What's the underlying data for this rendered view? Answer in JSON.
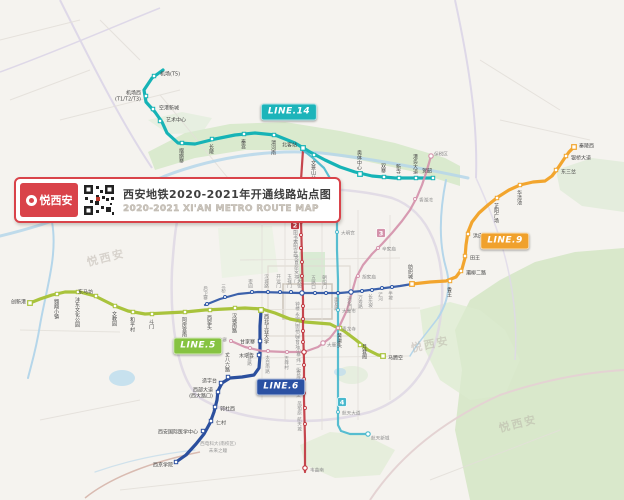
{
  "banner": {
    "logo_text": "悦西安",
    "title_cn": "西安地铁2020-2021年开通线路站点图",
    "title_en": "2020-2021 XI'AN METRO ROUTE MAP",
    "accent_color": "#d9434a"
  },
  "line_labels": [
    {
      "id": "14",
      "text": "LINE.14",
      "color": "#1cb4ba",
      "x": 289,
      "y": 112
    },
    {
      "id": "9",
      "text": "LINE.9",
      "color": "#f0a12c",
      "x": 505,
      "y": 241
    },
    {
      "id": "5",
      "text": "LINE.5",
      "color": "#86c341",
      "x": 198,
      "y": 346
    },
    {
      "id": "6",
      "text": "LINE.6",
      "color": "#2b51a3",
      "x": 281,
      "y": 387
    }
  ],
  "badges": [
    {
      "text": "2",
      "color": "#c13740",
      "x": 295,
      "y": 225
    },
    {
      "text": "3",
      "color": "#d492ab",
      "x": 381,
      "y": 233
    },
    {
      "text": "4",
      "color": "#49b9cd",
      "x": 342,
      "y": 402
    }
  ],
  "watermarks": [
    {
      "text": "悦西安",
      "x": 88,
      "y": 266,
      "angle": -14
    },
    {
      "text": "悦西安",
      "x": 412,
      "y": 352,
      "angle": -12
    },
    {
      "text": "悦西安",
      "x": 500,
      "y": 432,
      "angle": -14
    }
  ],
  "area_labels": [
    {
      "text": "西电科大(南校区)",
      "x": 218,
      "y": 445
    },
    {
      "text": "未来之瞳",
      "x": 218,
      "y": 452
    }
  ],
  "lines": [
    {
      "id": "14",
      "name": "14号线",
      "color": "#16b3b6",
      "w": 3.2,
      "new": true,
      "pts": [
        [
          163,
          70
        ],
        [
          152,
          78
        ],
        [
          144,
          90
        ],
        [
          146,
          102
        ],
        [
          155,
          112
        ],
        [
          162,
          122
        ],
        [
          167,
          133
        ],
        [
          178,
          143
        ],
        [
          195,
          144
        ],
        [
          215,
          139
        ],
        [
          235,
          135
        ],
        [
          255,
          133
        ],
        [
          275,
          135
        ],
        [
          295,
          143
        ],
        [
          310,
          152
        ],
        [
          325,
          160
        ],
        [
          340,
          167
        ],
        [
          355,
          172
        ],
        [
          372,
          176
        ],
        [
          395,
          178
        ],
        [
          433,
          178
        ]
      ]
    },
    {
      "id": "9",
      "name": "9号线",
      "color": "#f2a52e",
      "w": 3.2,
      "new": true,
      "pts": [
        [
          412,
          284
        ],
        [
          430,
          282
        ],
        [
          446,
          281
        ],
        [
          456,
          277
        ],
        [
          462,
          269
        ],
        [
          465,
          258
        ],
        [
          466,
          245
        ],
        [
          468,
          232
        ],
        [
          472,
          222
        ],
        [
          479,
          213
        ],
        [
          488,
          205
        ],
        [
          498,
          197
        ],
        [
          509,
          190
        ],
        [
          520,
          185
        ],
        [
          533,
          182
        ],
        [
          545,
          181
        ],
        [
          552,
          176
        ],
        [
          558,
          168
        ],
        [
          564,
          159
        ],
        [
          569,
          152
        ],
        [
          574,
          147
        ]
      ]
    },
    {
      "id": "5",
      "name": "5号线",
      "color": "#a9c33c",
      "w": 3.2,
      "new": true,
      "pts": [
        [
          30,
          303
        ],
        [
          40,
          299
        ],
        [
          52,
          295
        ],
        [
          65,
          292
        ],
        [
          80,
          292
        ],
        [
          95,
          296
        ],
        [
          105,
          301
        ],
        [
          115,
          306
        ],
        [
          128,
          311
        ],
        [
          145,
          314
        ],
        [
          165,
          313
        ],
        [
          185,
          312
        ],
        [
          205,
          310
        ],
        [
          225,
          309
        ],
        [
          245,
          308
        ],
        [
          262,
          309
        ],
        [
          275,
          313
        ],
        [
          290,
          319
        ],
        [
          305,
          322
        ],
        [
          330,
          324
        ],
        [
          344,
          331
        ],
        [
          356,
          340
        ],
        [
          368,
          350
        ],
        [
          378,
          355
        ],
        [
          384,
          356
        ]
      ]
    },
    {
      "id": "6",
      "name": "6号线",
      "color": "#2b4f9e",
      "w": 3.2,
      "new": true,
      "pts": [
        [
          176,
          462
        ],
        [
          186,
          455
        ],
        [
          196,
          444
        ],
        [
          204,
          434
        ],
        [
          210,
          423
        ],
        [
          214,
          412
        ],
        [
          217,
          400
        ],
        [
          218,
          391
        ],
        [
          222,
          383
        ],
        [
          230,
          378
        ],
        [
          242,
          377
        ],
        [
          254,
          375
        ],
        [
          259,
          368
        ],
        [
          260,
          355
        ],
        [
          260,
          340
        ],
        [
          260,
          326
        ],
        [
          261,
          311
        ]
      ]
    },
    {
      "id": "1",
      "name": "1号线",
      "color": "#2b55a5",
      "w": 2.2,
      "new": false,
      "pts": [
        [
          205,
          305
        ],
        [
          220,
          299
        ],
        [
          238,
          294
        ],
        [
          258,
          292
        ],
        [
          300,
          293
        ],
        [
          340,
          293
        ],
        [
          362,
          291
        ],
        [
          385,
          288
        ],
        [
          400,
          286
        ],
        [
          412,
          284
        ]
      ]
    },
    {
      "id": "2",
      "name": "2号线",
      "color": "#c13740",
      "w": 2.2,
      "new": false,
      "pts": [
        [
          303,
          150
        ],
        [
          301,
          180
        ],
        [
          301,
          220
        ],
        [
          302,
          260
        ],
        [
          303,
          300
        ],
        [
          303,
          330
        ],
        [
          304,
          360
        ],
        [
          304,
          400
        ],
        [
          305,
          440
        ],
        [
          305,
          472
        ]
      ]
    },
    {
      "id": "3",
      "name": "3号线",
      "color": "#d492ab",
      "w": 2.2,
      "new": false,
      "pts": [
        [
          231,
          341
        ],
        [
          245,
          347
        ],
        [
          262,
          351
        ],
        [
          285,
          352
        ],
        [
          304,
          352
        ],
        [
          318,
          347
        ],
        [
          330,
          338
        ],
        [
          340,
          325
        ],
        [
          347,
          310
        ],
        [
          352,
          292
        ],
        [
          356,
          278
        ],
        [
          363,
          265
        ],
        [
          372,
          254
        ],
        [
          382,
          244
        ],
        [
          392,
          233
        ],
        [
          402,
          221
        ],
        [
          410,
          210
        ],
        [
          417,
          197
        ],
        [
          422,
          185
        ],
        [
          426,
          173
        ],
        [
          429,
          163
        ],
        [
          431,
          156
        ]
      ]
    },
    {
      "id": "4",
      "name": "4号线",
      "color": "#49b9cd",
      "w": 2.2,
      "new": false,
      "pts": [
        [
          303,
          150
        ],
        [
          313,
          158
        ],
        [
          324,
          168
        ],
        [
          331,
          180
        ],
        [
          335,
          195
        ],
        [
          337,
          215
        ],
        [
          337,
          250
        ],
        [
          338,
          280
        ],
        [
          338,
          310
        ],
        [
          338,
          345
        ],
        [
          338,
          380
        ],
        [
          338,
          408
        ],
        [
          338,
          425
        ],
        [
          341,
          431
        ],
        [
          350,
          434
        ],
        [
          368,
          434
        ]
      ]
    }
  ],
  "stations": [
    [
      "机场(T5)",
      "14",
      154,
      76,
      160,
      74,
      "h",
      "s"
    ],
    [
      [
        "机场西",
        "(T1/T2/T3)"
      ],
      "14",
      146,
      96,
      141,
      93,
      "h",
      "e"
    ],
    [
      "空港新城",
      "14",
      153,
      109,
      159,
      108,
      "h",
      "s"
    ],
    [
      "艺术中心",
      "14",
      160,
      121,
      166,
      120,
      "h",
      "s"
    ],
    [
      "摆旗寨",
      "14",
      182,
      143,
      181,
      148,
      "v",
      "s"
    ],
    [
      "长陵",
      "14",
      212,
      139,
      211,
      144,
      "v",
      "s"
    ],
    [
      "秦宫",
      "14",
      244,
      134,
      243,
      139,
      "v",
      "s"
    ],
    [
      "渭河南",
      "14",
      274,
      135,
      273,
      140,
      "v",
      "s"
    ],
    [
      "北客站",
      "14",
      303,
      148,
      297,
      145,
      "h",
      "e",
      "m"
    ],
    [
      "文景山公园",
      "14",
      314,
      155,
      313,
      160,
      "v",
      "s"
    ],
    [
      "奥体中心",
      "14",
      360,
      174,
      359,
      170,
      "v",
      "e",
      "m"
    ],
    [
      "双寨",
      "14",
      384,
      177,
      383,
      173,
      "v",
      "e"
    ],
    [
      "新寺",
      "14",
      399,
      178,
      398,
      174,
      "v",
      "e"
    ],
    [
      "港务大道",
      "14",
      416,
      178,
      415,
      174,
      "v",
      "e"
    ],
    [
      "贺韶",
      "14",
      433,
      178,
      432,
      171,
      "h",
      "e"
    ],
    [
      "纺织城",
      "9",
      412,
      284,
      410,
      279,
      "v",
      "e",
      "m"
    ],
    [
      "香王",
      "9",
      450,
      281,
      449,
      287,
      "v",
      "s"
    ],
    [
      "灞柳二路",
      "9",
      461,
      271,
      466,
      273,
      "h",
      "s"
    ],
    [
      "田王",
      "9",
      465,
      256,
      470,
      258,
      "h",
      "s"
    ],
    [
      "洪庆",
      "9",
      468,
      234,
      473,
      236,
      "h",
      "s"
    ],
    [
      "芷阳广场",
      "9",
      497,
      198,
      496,
      203,
      "v",
      "s"
    ],
    [
      "华清池",
      "9",
      520,
      185,
      519,
      190,
      "v",
      "s"
    ],
    [
      "东三岔",
      "9",
      556,
      170,
      561,
      172,
      "h",
      "s"
    ],
    [
      "银桥大道",
      "9",
      566,
      156,
      571,
      158,
      "h",
      "s"
    ],
    [
      "秦陵西",
      "9",
      574,
      147,
      579,
      146,
      "h",
      "s",
      "m"
    ],
    [
      "创新港",
      "5",
      30,
      303,
      26,
      302,
      "h",
      "e",
      "m"
    ],
    [
      "翱翔小镇",
      "5",
      57,
      294,
      56,
      299,
      "v",
      "s"
    ],
    [
      "沣东文化公园",
      "5",
      78,
      292,
      77,
      297,
      "v",
      "s"
    ],
    [
      "东马坊",
      "5",
      96,
      296,
      93,
      292,
      "h",
      "e"
    ],
    [
      "文教园",
      "5",
      115,
      306,
      114,
      311,
      "v",
      "s"
    ],
    [
      "和平村",
      "5",
      133,
      312,
      132,
      317,
      "v",
      "s"
    ],
    [
      "斗门",
      "5",
      152,
      314,
      151,
      319,
      "v",
      "s"
    ],
    [
      "阿房宫南",
      "5",
      185,
      312,
      184,
      317,
      "v",
      "s"
    ],
    [
      "西窑头",
      "5",
      210,
      310,
      209,
      315,
      "v",
      "s"
    ],
    [
      "汉城南路",
      "5",
      235,
      308,
      234,
      313,
      "v",
      "s"
    ],
    [
      "西北工业大学",
      "5",
      261,
      310,
      266,
      314,
      "v",
      "s",
      "m"
    ],
    [
      "黄渠头",
      "5",
      340,
      328,
      339,
      333,
      "v",
      "s"
    ],
    [
      "月登阁",
      "5",
      360,
      345,
      364,
      344,
      "v",
      "s"
    ],
    [
      "马腾空",
      "5",
      383,
      356,
      388,
      358,
      "h",
      "s",
      "m"
    ],
    [
      "西京学院",
      "6",
      176,
      462,
      173,
      465,
      "h",
      "e"
    ],
    [
      "西安国际医学中心",
      "6",
      203,
      431,
      198,
      432,
      "h",
      "e"
    ],
    [
      "仁村",
      "6",
      211,
      421,
      216,
      423,
      "h",
      "s"
    ],
    [
      "郭杜西",
      "6",
      215,
      407,
      220,
      409,
      "h",
      "s"
    ],
    [
      [
        "西部大道",
        "(西大路口)"
      ],
      "6",
      218,
      392,
      213,
      390,
      "h",
      "e"
    ],
    [
      "造字台",
      "6",
      221,
      383,
      217,
      381,
      "h",
      "e"
    ],
    [
      "丈八六路",
      "6",
      228,
      377,
      227,
      372,
      "v",
      "e"
    ],
    [
      "木塔寺",
      "6",
      259,
      355,
      254,
      356,
      "h",
      "e"
    ],
    [
      "甘家寨",
      "6",
      260,
      341,
      255,
      342,
      "h",
      "e"
    ],
    [
      "后卫寨",
      "1",
      207,
      304,
      205,
      300,
      "v",
      "e"
    ],
    [
      "三桥",
      "1",
      225,
      297,
      223,
      293,
      "v",
      "e"
    ],
    [
      "枣园",
      "1",
      252,
      292,
      250,
      288,
      "v",
      "e"
    ],
    [
      "汉城路",
      "1",
      268,
      292,
      266,
      288,
      "v",
      "e"
    ],
    [
      "开远门",
      "1",
      280,
      292,
      278,
      288,
      "v",
      "e"
    ],
    [
      "玉祥门",
      "1",
      291,
      292,
      289,
      288,
      "v",
      "e"
    ],
    [
      "北大街",
      "1",
      302,
      293,
      299,
      288,
      "v",
      "e",
      "m"
    ],
    [
      "五路口",
      "1",
      315,
      293,
      313,
      289,
      "v",
      "e"
    ],
    [
      "朝阳门",
      "1",
      326,
      293,
      324,
      289,
      "v",
      "e"
    ],
    [
      "康复路",
      "1",
      338,
      293,
      336,
      297,
      "v",
      "s"
    ],
    [
      "通化门",
      "1",
      351,
      292,
      349,
      296,
      "v",
      "s",
      "m"
    ],
    [
      "万寿路",
      "1",
      362,
      291,
      360,
      295,
      "v",
      "s"
    ],
    [
      "长乐坡",
      "1",
      372,
      290,
      370,
      294,
      "v",
      "s"
    ],
    [
      "浐河",
      "1",
      382,
      288,
      380,
      292,
      "v",
      "s"
    ],
    [
      "半坡",
      "1",
      392,
      287,
      390,
      291,
      "v",
      "s"
    ],
    [
      "运动公园",
      "2",
      300,
      196,
      294,
      196,
      "v",
      "m"
    ],
    [
      "行政中心",
      "2",
      300,
      209,
      294,
      209,
      "v",
      "m"
    ],
    [
      "凤城五路",
      "2",
      301,
      222,
      295,
      222,
      "v",
      "m"
    ],
    [
      "市图书馆",
      "2",
      301,
      235,
      295,
      235,
      "v",
      "m"
    ],
    [
      "大明宫西",
      "2",
      301,
      248,
      295,
      248,
      "v",
      "m"
    ],
    [
      "龙首原",
      "2",
      302,
      262,
      296,
      262,
      "v",
      "m"
    ],
    [
      "安远门",
      "2",
      302,
      276,
      296,
      276,
      "v",
      "m"
    ],
    [
      "钟楼",
      "2",
      303,
      306,
      297,
      306,
      "v",
      "m"
    ],
    [
      "永宁门",
      "2",
      303,
      319,
      297,
      319,
      "v",
      "m"
    ],
    [
      "南稍门",
      "2",
      303,
      331,
      297,
      331,
      "v",
      "m"
    ],
    [
      "体育场",
      "2",
      303,
      342,
      297,
      342,
      "v",
      "m"
    ],
    [
      "小寨",
      "2",
      304,
      352,
      298,
      352,
      "v",
      "m",
      "m"
    ],
    [
      "纬一街",
      "2",
      304,
      365,
      298,
      365,
      "v",
      "m"
    ],
    [
      "会展中心",
      "2",
      304,
      379,
      298,
      379,
      "v",
      "m"
    ],
    [
      "三爻",
      "2",
      304,
      393,
      298,
      393,
      "v",
      "m"
    ],
    [
      "凤栖原",
      "2",
      305,
      408,
      299,
      408,
      "v",
      "m"
    ],
    [
      "航天城",
      "2",
      305,
      424,
      299,
      424,
      "v",
      "m"
    ],
    [
      "韦曲南",
      "2",
      305,
      468,
      310,
      470,
      "h",
      "s",
      "m"
    ],
    [
      "鱼化寨",
      "3",
      231,
      341,
      227,
      340,
      "h",
      "e"
    ],
    [
      "科技路",
      "3",
      250,
      348,
      249,
      352,
      "v",
      "s"
    ],
    [
      "太白南路",
      "3",
      268,
      351,
      267,
      355,
      "v",
      "s"
    ],
    [
      "吉祥村",
      "3",
      287,
      352,
      286,
      356,
      "v",
      "s"
    ],
    [
      "大雁塔",
      "3",
      323,
      343,
      327,
      345,
      "h",
      "s",
      "m"
    ],
    [
      "青龙寺",
      "3",
      338,
      328,
      342,
      329,
      "h",
      "s"
    ],
    [
      "胡家庙",
      "3",
      358,
      276,
      362,
      277,
      "h",
      "s"
    ],
    [
      "辛家庙",
      "3",
      378,
      248,
      382,
      249,
      "h",
      "s"
    ],
    [
      "香湖湾",
      "3",
      415,
      199,
      419,
      200,
      "h",
      "s"
    ],
    [
      "保税区",
      "3",
      431,
      156,
      434,
      154,
      "h",
      "s",
      "m"
    ],
    [
      "大明宫",
      "4",
      337,
      232,
      341,
      233,
      "h",
      "s"
    ],
    [
      "大差市",
      "4",
      338,
      310,
      342,
      311,
      "h",
      "s"
    ],
    [
      "航天大道",
      "4",
      338,
      412,
      342,
      413,
      "h",
      "s"
    ],
    [
      "航天新城",
      "4",
      368,
      434,
      371,
      438,
      "h",
      "s",
      "m"
    ]
  ]
}
